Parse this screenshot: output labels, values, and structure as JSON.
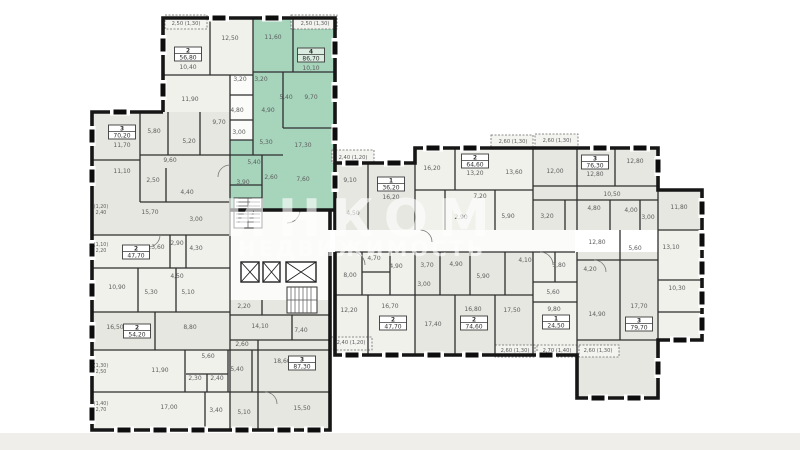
{
  "watermark": {
    "line1": "ИНКОМ",
    "line2": "НЕДВИЖИМОСТЬ"
  },
  "plan": {
    "highlight_color": "#a6d5bc",
    "apartments": [
      {
        "rooms": "2",
        "area": "56,80",
        "x": 188,
        "y": 47,
        "hl": false
      },
      {
        "rooms": "4",
        "area": "86,70",
        "x": 311,
        "y": 48,
        "hl": true
      },
      {
        "rooms": "3",
        "area": "70,20",
        "x": 122,
        "y": 125,
        "hl": false
      },
      {
        "rooms": "2",
        "area": "47,70",
        "x": 136,
        "y": 245,
        "hl": false
      },
      {
        "rooms": "2",
        "area": "54,20",
        "x": 137,
        "y": 324,
        "hl": false
      },
      {
        "rooms": "3",
        "area": "87,30",
        "x": 302,
        "y": 356,
        "hl": false
      },
      {
        "rooms": "1",
        "area": "36,20",
        "x": 391,
        "y": 177,
        "hl": false
      },
      {
        "rooms": "2",
        "area": "64,60",
        "x": 475,
        "y": 154,
        "hl": false
      },
      {
        "rooms": "3",
        "area": "76,30",
        "x": 595,
        "y": 155,
        "hl": false
      },
      {
        "rooms": "2",
        "area": "47,70",
        "x": 393,
        "y": 316,
        "hl": false
      },
      {
        "rooms": "2",
        "area": "74,60",
        "x": 474,
        "y": 316,
        "hl": false
      },
      {
        "rooms": "1",
        "area": "24,50",
        "x": 556,
        "y": 315,
        "hl": false
      },
      {
        "rooms": "3",
        "area": "79,70",
        "x": 639,
        "y": 317,
        "hl": false
      }
    ],
    "room_labels": [
      {
        "t": "12,50",
        "x": 230,
        "y": 40
      },
      {
        "t": "10,40",
        "x": 188,
        "y": 69
      },
      {
        "t": "11,60",
        "x": 273,
        "y": 39
      },
      {
        "t": "10,10",
        "x": 311,
        "y": 70
      },
      {
        "t": "3,20",
        "x": 240,
        "y": 81
      },
      {
        "t": "3,20",
        "x": 261,
        "y": 81
      },
      {
        "t": "11,90",
        "x": 190,
        "y": 101
      },
      {
        "t": "5,40",
        "x": 286,
        "y": 99
      },
      {
        "t": "9,70",
        "x": 311,
        "y": 99
      },
      {
        "t": "4,80",
        "x": 237,
        "y": 112
      },
      {
        "t": "4,90",
        "x": 268,
        "y": 112
      },
      {
        "t": "9,70",
        "x": 219,
        "y": 124
      },
      {
        "t": "5,80",
        "x": 154,
        "y": 133
      },
      {
        "t": "11,70",
        "x": 122,
        "y": 147
      },
      {
        "t": "3,00",
        "x": 239,
        "y": 134
      },
      {
        "t": "5,30",
        "x": 266,
        "y": 144
      },
      {
        "t": "5,20",
        "x": 189,
        "y": 143
      },
      {
        "t": "17,30",
        "x": 303,
        "y": 147
      },
      {
        "t": "9,60",
        "x": 170,
        "y": 162
      },
      {
        "t": "5,40",
        "x": 254,
        "y": 164
      },
      {
        "t": "11,10",
        "x": 122,
        "y": 173
      },
      {
        "t": "2,50",
        "x": 153,
        "y": 182
      },
      {
        "t": "2,60",
        "x": 271,
        "y": 179
      },
      {
        "t": "3,90",
        "x": 243,
        "y": 184
      },
      {
        "t": "7,60",
        "x": 303,
        "y": 181
      },
      {
        "t": "4,40",
        "x": 187,
        "y": 194
      },
      {
        "t": "15,70",
        "x": 150,
        "y": 214
      },
      {
        "t": "3,00",
        "x": 196,
        "y": 221
      },
      {
        "t": "2,90",
        "x": 177,
        "y": 245
      },
      {
        "t": "13,60",
        "x": 156,
        "y": 249
      },
      {
        "t": "4,30",
        "x": 196,
        "y": 250
      },
      {
        "t": "4,50",
        "x": 177,
        "y": 278
      },
      {
        "t": "10,90",
        "x": 117,
        "y": 289
      },
      {
        "t": "5,30",
        "x": 151,
        "y": 294
      },
      {
        "t": "5,10",
        "x": 188,
        "y": 294
      },
      {
        "t": "2,20",
        "x": 244,
        "y": 308
      },
      {
        "t": "16,50",
        "x": 115,
        "y": 329
      },
      {
        "t": "8,80",
        "x": 190,
        "y": 329
      },
      {
        "t": "14,10",
        "x": 260,
        "y": 328
      },
      {
        "t": "7,40",
        "x": 301,
        "y": 332
      },
      {
        "t": "2,60",
        "x": 242,
        "y": 346
      },
      {
        "t": "5,60",
        "x": 208,
        "y": 358
      },
      {
        "t": "18,60",
        "x": 282,
        "y": 363
      },
      {
        "t": "11,90",
        "x": 160,
        "y": 372
      },
      {
        "t": "5,40",
        "x": 237,
        "y": 371
      },
      {
        "t": "2,30",
        "x": 195,
        "y": 380
      },
      {
        "t": "2,40",
        "x": 217,
        "y": 380
      },
      {
        "t": "17,00",
        "x": 169,
        "y": 409
      },
      {
        "t": "3,40",
        "x": 216,
        "y": 412
      },
      {
        "t": "5,10",
        "x": 244,
        "y": 414
      },
      {
        "t": "15,50",
        "x": 302,
        "y": 410
      },
      {
        "t": "9,10",
        "x": 350,
        "y": 182
      },
      {
        "t": "16,20",
        "x": 391,
        "y": 199
      },
      {
        "t": "4,50",
        "x": 353,
        "y": 215
      },
      {
        "t": "16,20",
        "x": 432,
        "y": 170
      },
      {
        "t": "13,20",
        "x": 475,
        "y": 175
      },
      {
        "t": "7,20",
        "x": 480,
        "y": 198
      },
      {
        "t": "2,90",
        "x": 461,
        "y": 219
      },
      {
        "t": "5,90",
        "x": 508,
        "y": 218
      },
      {
        "t": "13,60",
        "x": 514,
        "y": 174
      },
      {
        "t": "12,00",
        "x": 555,
        "y": 173
      },
      {
        "t": "12,80",
        "x": 595,
        "y": 176
      },
      {
        "t": "12,80",
        "x": 635,
        "y": 163
      },
      {
        "t": "10,50",
        "x": 612,
        "y": 196
      },
      {
        "t": "4,80",
        "x": 594,
        "y": 210
      },
      {
        "t": "4,00",
        "x": 631,
        "y": 212
      },
      {
        "t": "3,00",
        "x": 648,
        "y": 219
      },
      {
        "t": "3,20",
        "x": 547,
        "y": 218
      },
      {
        "t": "11,80",
        "x": 679,
        "y": 209
      },
      {
        "t": "4,70",
        "x": 374,
        "y": 260
      },
      {
        "t": "4,90",
        "x": 396,
        "y": 268
      },
      {
        "t": "3,70",
        "x": 427,
        "y": 267
      },
      {
        "t": "4,90",
        "x": 456,
        "y": 266
      },
      {
        "t": "4,10",
        "x": 525,
        "y": 262
      },
      {
        "t": "3,80",
        "x": 559,
        "y": 267
      },
      {
        "t": "4,20",
        "x": 590,
        "y": 271
      },
      {
        "t": "3,00",
        "x": 424,
        "y": 286
      },
      {
        "t": "5,90",
        "x": 483,
        "y": 278
      },
      {
        "t": "8,00",
        "x": 350,
        "y": 277
      },
      {
        "t": "12,80",
        "x": 597,
        "y": 244
      },
      {
        "t": "5,60",
        "x": 635,
        "y": 250
      },
      {
        "t": "13,10",
        "x": 671,
        "y": 249
      },
      {
        "t": "12,20",
        "x": 349,
        "y": 312
      },
      {
        "t": "16,70",
        "x": 390,
        "y": 308
      },
      {
        "t": "17,40",
        "x": 433,
        "y": 326
      },
      {
        "t": "16,80",
        "x": 473,
        "y": 311
      },
      {
        "t": "17,50",
        "x": 512,
        "y": 312
      },
      {
        "t": "5,60",
        "x": 553,
        "y": 294
      },
      {
        "t": "9,80",
        "x": 554,
        "y": 311
      },
      {
        "t": "10,30",
        "x": 677,
        "y": 290
      },
      {
        "t": "14,90",
        "x": 597,
        "y": 316
      },
      {
        "t": "17,70",
        "x": 639,
        "y": 308
      }
    ],
    "balcony_labels": [
      {
        "t": "2,50 (1,30)",
        "x": 186,
        "y": 25
      },
      {
        "t": "2,50 (1,30)",
        "x": 315,
        "y": 25
      },
      {
        "t": "2,40 (1,20)",
        "x": 353,
        "y": 159
      },
      {
        "t": "2,60 (1,30)",
        "x": 513,
        "y": 143
      },
      {
        "t": "2,60 (1,30)",
        "x": 557,
        "y": 142
      },
      {
        "t": "2,40 (1,20)",
        "x": 351,
        "y": 344
      },
      {
        "t": "2,60 (1,30)",
        "x": 515,
        "y": 352
      },
      {
        "t": "2,70 (1,40)",
        "x": 557,
        "y": 352
      },
      {
        "t": "2,60 (1,30)",
        "x": 598,
        "y": 352
      }
    ],
    "edge_labels": [
      {
        "t1": "(1,20)",
        "t2": "2,40",
        "x": 101,
        "y": 210
      },
      {
        "t1": "(1,10)",
        "t2": "2,20",
        "x": 101,
        "y": 248
      },
      {
        "t1": "(1,30)",
        "t2": "2,50",
        "x": 101,
        "y": 369
      },
      {
        "t1": "(1,40)",
        "t2": "2,70",
        "x": 101,
        "y": 407
      }
    ]
  }
}
